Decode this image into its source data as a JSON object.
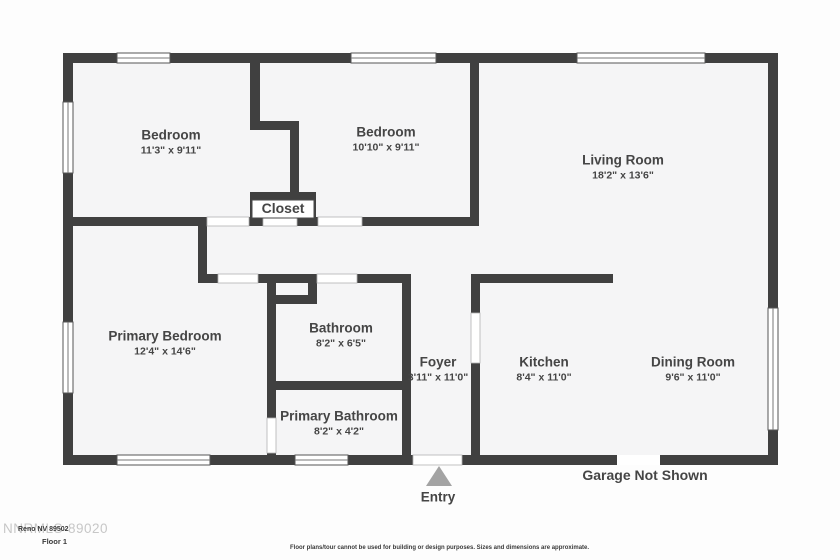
{
  "plan": {
    "rooms": [
      {
        "name": "Bedroom",
        "dims": "11'3\" x 9'11\""
      },
      {
        "name": "Bedroom",
        "dims": "10'10\" x 9'11\""
      },
      {
        "name": "Living Room",
        "dims": "18'2\" x 13'6\""
      },
      {
        "name": "Closet",
        "dims": ""
      },
      {
        "name": "Primary Bedroom",
        "dims": "12'4\" x 14'6\""
      },
      {
        "name": "Bathroom",
        "dims": "8'2\" x 6'5\""
      },
      {
        "name": "Foyer",
        "dims": "3'11\" x 11'0\""
      },
      {
        "name": "Kitchen",
        "dims": "8'4\" x 11'0\""
      },
      {
        "name": "Dining Room",
        "dims": "9'6\" x 11'0\""
      },
      {
        "name": "Primary Bathroom",
        "dims": "8'2\" x 4'2\""
      }
    ],
    "annotations": {
      "entry_label": "Entry",
      "garage_note": "Garage Not Shown"
    },
    "footer": {
      "watermark": "NNRMLS-89020",
      "address_line": "Reno NV 89502",
      "floor_label": "Floor 1",
      "disclaimer": "Floor plans/tour cannot be used for building or design purposes. Sizes and dimensions are approximate."
    },
    "colors": {
      "wall": "#404040",
      "room_fill": "#f5f5f6",
      "text": "#454545",
      "entry_arrow": "#a3a3a3",
      "background": "#fdfdfd"
    }
  }
}
